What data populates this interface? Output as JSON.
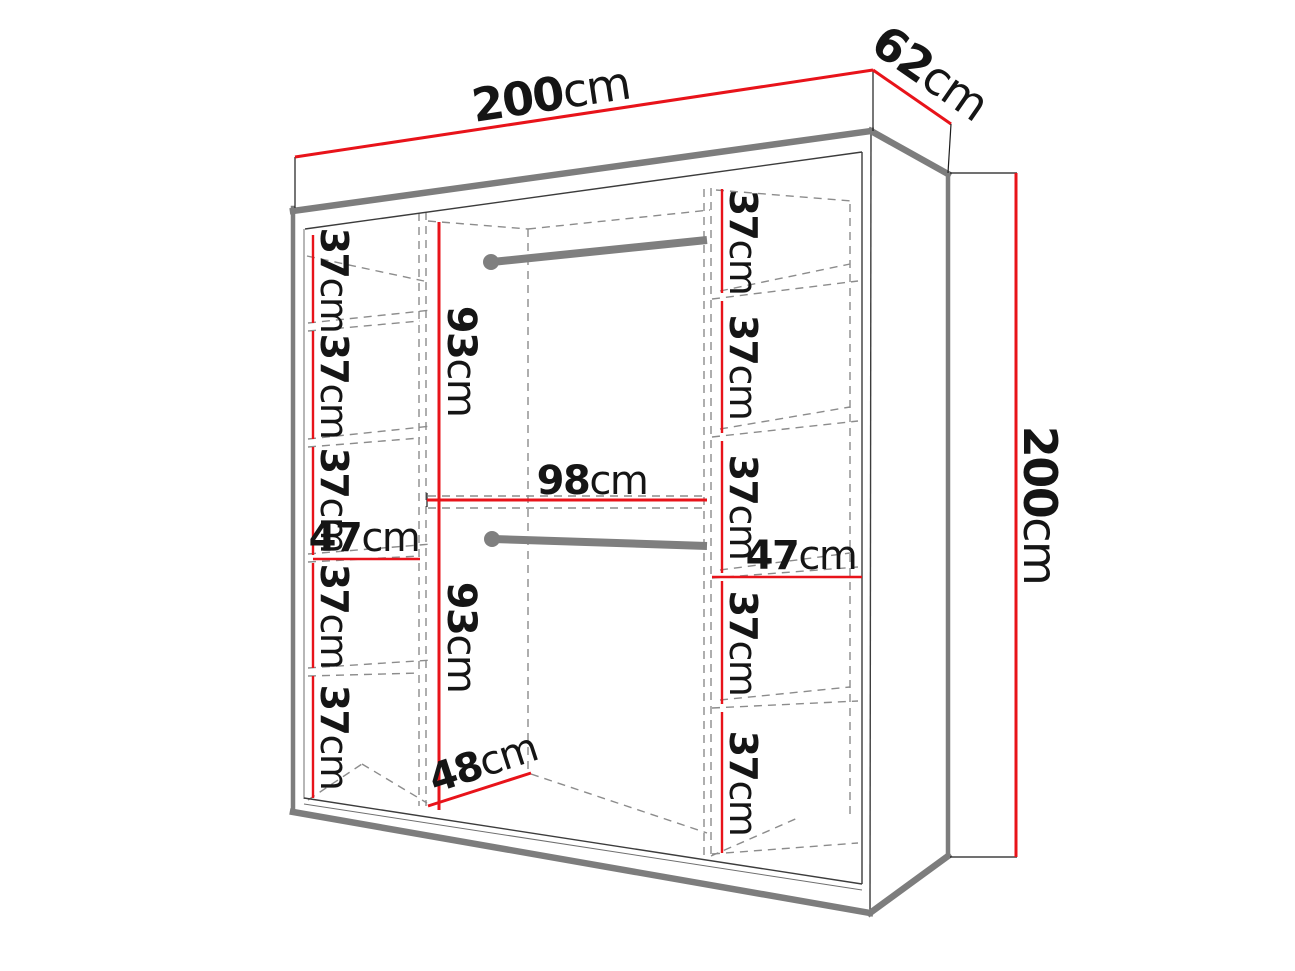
{
  "title": "Wardrobe dimensions technical diagram",
  "colors": {
    "dimension_red": "#e8131a",
    "edge_gray": "#7d7d7d",
    "line_dark": "#3c3c3c",
    "dash_gray": "#8c8c8c",
    "rail_gray": "#7f7f7f",
    "label_ink": "#151515"
  },
  "overall": {
    "width": {
      "value": "200",
      "unit": "cm"
    },
    "depth": {
      "value": "62",
      "unit": "cm"
    },
    "height": {
      "value": "200",
      "unit": "cm"
    }
  },
  "left_column": {
    "inner_width": {
      "value": "47",
      "unit": "cm"
    },
    "gaps": [
      {
        "value": "37",
        "unit": "cm"
      },
      {
        "value": "37",
        "unit": "cm"
      },
      {
        "value": "37",
        "unit": "cm"
      },
      {
        "value": "37",
        "unit": "cm"
      },
      {
        "value": "37",
        "unit": "cm"
      }
    ]
  },
  "right_column": {
    "inner_width": {
      "value": "47",
      "unit": "cm"
    },
    "gaps": [
      {
        "value": "37",
        "unit": "cm"
      },
      {
        "value": "37",
        "unit": "cm"
      },
      {
        "value": "37",
        "unit": "cm"
      },
      {
        "value": "37",
        "unit": "cm"
      },
      {
        "value": "37",
        "unit": "cm"
      }
    ]
  },
  "center_section": {
    "upper_height": {
      "value": "93",
      "unit": "cm"
    },
    "inner_width": {
      "value": "98",
      "unit": "cm"
    },
    "lower_height": {
      "value": "93",
      "unit": "cm"
    },
    "inner_depth": {
      "value": "48",
      "unit": "cm"
    }
  }
}
